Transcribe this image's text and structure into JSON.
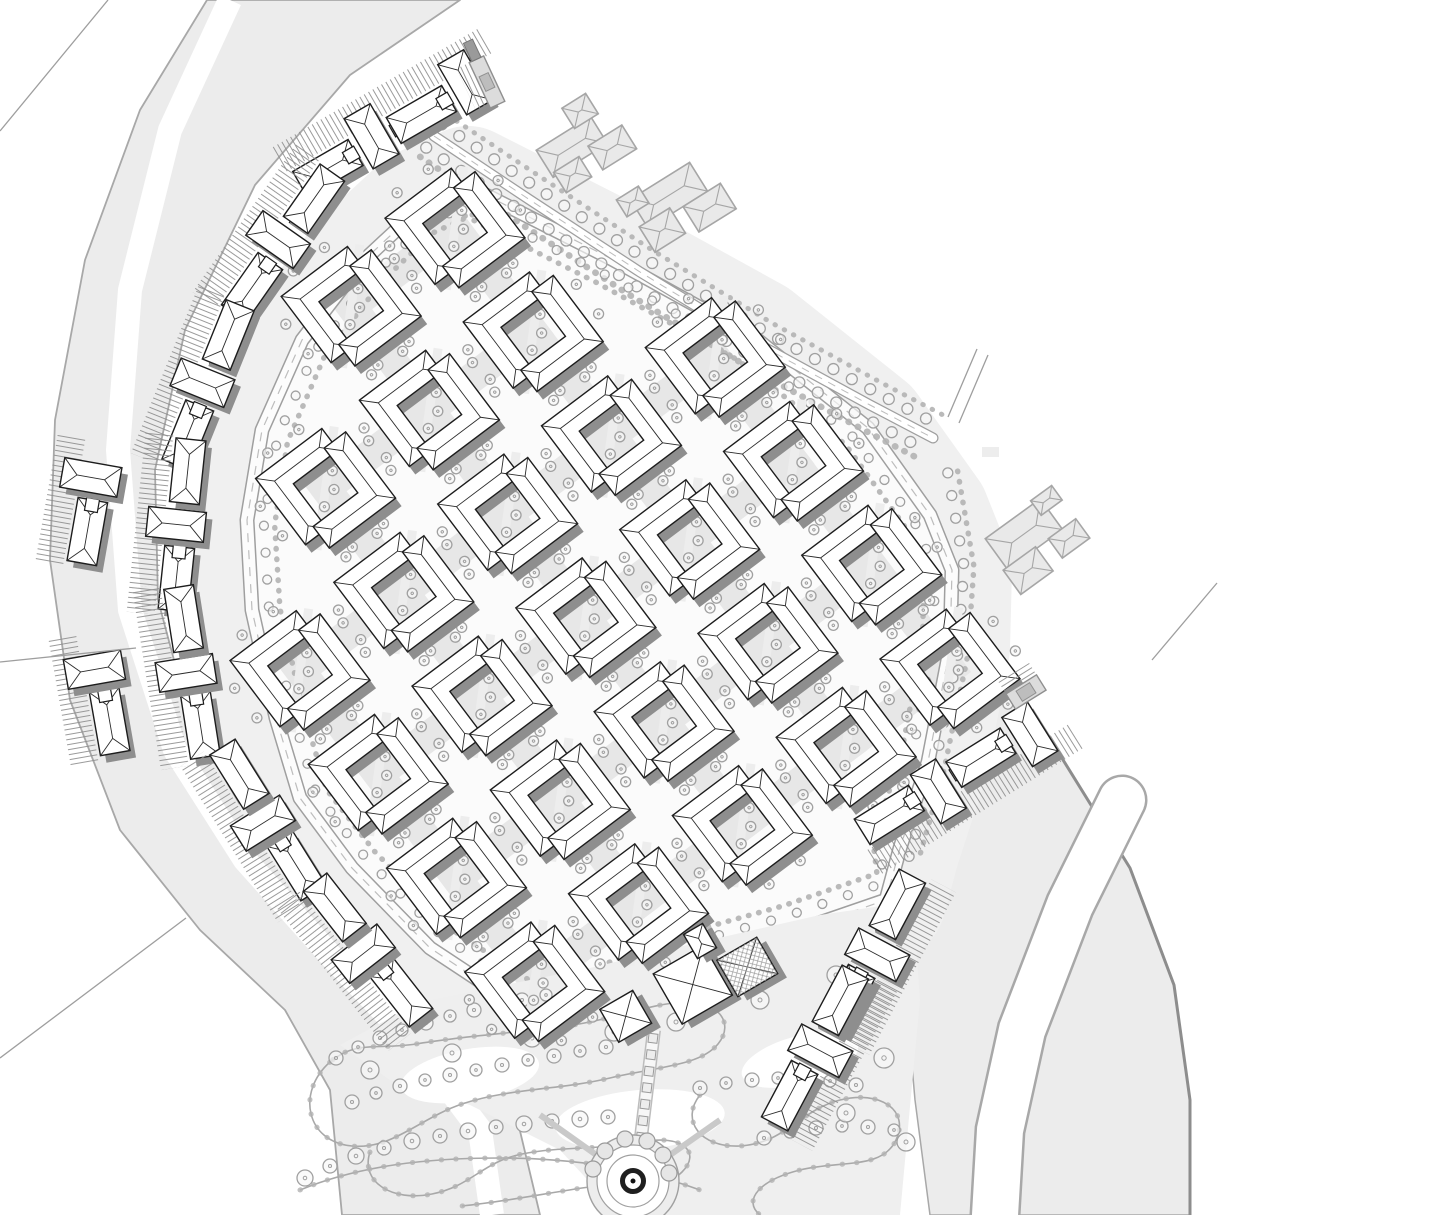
{
  "meta": {
    "drawing_type": "residential-master-site-plan",
    "canvas": {
      "w": 1448,
      "h": 1215
    }
  },
  "palette": {
    "bg": "#ffffff",
    "band_fill": "#ececec",
    "band_stroke": "#a8a8a8",
    "band_dark_edge": "#8d8d8d",
    "platform": "#f0f0f0",
    "site_fill": "#fbfbfb",
    "street": "#e7e7e7",
    "road_edge": "#9f9f9f",
    "road_fill": "#fcfcfc",
    "road_dash": "#bdbdbd",
    "tree_stroke": "#a0a0a0",
    "tree_fill": "#f7f7f7",
    "shrub": "#b2b2b2",
    "building_stroke": "#1c1c1c",
    "roof_line": "#2a2a2a",
    "shadow": "#8e8e8e",
    "hatch_line": "#8f8f8f",
    "context_fill": "#e9e9e9",
    "context_stroke": "#a6a6a6",
    "park_fill": "#efefef",
    "park_path": "#a8a8a8",
    "fountain_dark": "#1f1f1f"
  },
  "bands": {
    "west_poly": [
      207,
      0,
      140,
      110,
      85,
      260,
      55,
      420,
      50,
      560,
      70,
      700,
      120,
      830,
      200,
      930,
      285,
      1010,
      330,
      1090,
      342,
      1215,
      540,
      1215,
      515,
      1110,
      445,
      1020,
      350,
      925,
      255,
      830,
      190,
      720,
      158,
      600,
      155,
      470,
      185,
      330,
      255,
      185,
      350,
      75,
      460,
      0
    ],
    "west_white_stroke": [
      230,
      0,
      170,
      130,
      130,
      290,
      118,
      450,
      130,
      610,
      175,
      750,
      245,
      860,
      330,
      955,
      420,
      1050,
      480,
      1130,
      492,
      1215
    ],
    "west_white_width": 24,
    "southeast_poly": [
      985,
      660,
      1060,
      755,
      1130,
      868,
      1174,
      985,
      1190,
      1100,
      1190,
      1215,
      930,
      1215,
      915,
      1100,
      905,
      985,
      920,
      875,
      950,
      770,
      970,
      700
    ],
    "southeast_dark_edge": [
      985,
      660,
      1060,
      755,
      1130,
      868,
      1174,
      985,
      1190,
      1100,
      1190,
      1215
    ],
    "canal_path": [
      1122,
      800,
      1070,
      905,
      1022,
      1030,
      1000,
      1130,
      995,
      1215
    ],
    "canal_width": 46,
    "hairlines": [
      [
        948,
        417,
        977,
        349
      ],
      [
        959,
        423,
        988,
        355
      ],
      [
        1152,
        660,
        1217,
        583
      ],
      [
        0,
        131,
        108,
        0
      ],
      [
        0,
        1058,
        186,
        918
      ],
      [
        0,
        662,
        136,
        648
      ]
    ],
    "small_pad": {
      "x": 982,
      "y": 447,
      "w": 17,
      "h": 10
    }
  },
  "site": {
    "boundary": [
      468,
      186,
      610,
      258,
      755,
      338,
      868,
      428,
      930,
      515,
      952,
      570,
      950,
      648,
      928,
      762,
      900,
      848,
      886,
      900,
      790,
      933,
      700,
      958,
      620,
      988,
      548,
      1026,
      430,
      948,
      352,
      868,
      300,
      798,
      276,
      718,
      252,
      610,
      247,
      520,
      262,
      430,
      302,
      340,
      362,
      262,
      420,
      208
    ],
    "loop_road_width": 15,
    "platform_width": 120
  },
  "grid": {
    "origin": [
      455,
      228
    ],
    "angle_deg": -37,
    "pitch": 130,
    "block_size": 100,
    "cells": [
      [
        0,
        0
      ],
      [
        0,
        -1
      ],
      [
        1,
        0
      ],
      [
        1,
        -1
      ],
      [
        1,
        -2
      ],
      [
        2,
        1
      ],
      [
        2,
        0
      ],
      [
        2,
        -1
      ],
      [
        2,
        -2
      ],
      [
        2,
        -3
      ],
      [
        3,
        1
      ],
      [
        3,
        0
      ],
      [
        3,
        -1
      ],
      [
        3,
        -2
      ],
      [
        3,
        -3
      ],
      [
        4,
        1
      ],
      [
        4,
        0
      ],
      [
        4,
        -1
      ],
      [
        4,
        -2
      ],
      [
        4,
        -3
      ],
      [
        5,
        1
      ],
      [
        5,
        0
      ],
      [
        5,
        -1
      ],
      [
        5,
        -2
      ],
      [
        5,
        -3
      ]
    ],
    "street_width": 30
  },
  "boulevard": {
    "path": [
      434,
      136,
      530,
      200,
      640,
      272,
      760,
      345,
      870,
      405,
      933,
      438
    ],
    "road_width": 11,
    "tree_offset": 14,
    "tree_spacing": 21,
    "tree_r": 5.5,
    "shrub_offset": 25
  },
  "east_row": {
    "path": [
      936,
      475,
      952,
      565,
      946,
      652,
      922,
      768,
      897,
      855
    ],
    "tree_offset": -12,
    "tree_spacing": 23,
    "tree_r": 5
  },
  "loop_planting": {
    "offset": 17,
    "spacing": 27,
    "tree_r": 4.5
  },
  "chains": [
    {
      "c": [
        398,
        128
      ],
      "rot": -30,
      "units": 4,
      "hatch": -1
    },
    {
      "c": [
        283,
        243
      ],
      "rot": -55,
      "units": 3,
      "hatch": -1
    },
    {
      "c": [
        208,
        385
      ],
      "rot": -68,
      "units": 3,
      "hatch": -1
    },
    {
      "c": [
        182,
        525
      ],
      "rot": -84,
      "units": 3,
      "hatch": -1
    },
    {
      "c": [
        192,
        672
      ],
      "rot": -99,
      "units": 3,
      "hatch": -1
    },
    {
      "c": [
        268,
        820
      ],
      "rot": -122,
      "units": 3,
      "hatch": -1
    },
    {
      "c": [
        368,
        950
      ],
      "rot": -128,
      "units": 3,
      "hatch": -1
    },
    {
      "c": [
        92,
        505
      ],
      "rot": -80,
      "units": 2,
      "hatch": -1
    },
    {
      "c": [
        105,
        695
      ],
      "rot": -100,
      "units": 2,
      "hatch": -1
    },
    {
      "c": [
        958,
        772
      ],
      "rot": -32,
      "units": 4,
      "hatch": 1
    },
    {
      "c": [
        872,
        952
      ],
      "rot": -62,
      "units": 3,
      "hatch": 1
    },
    {
      "c": [
        815,
        1048
      ],
      "rot": -62,
      "units": 3,
      "hatch": 1
    }
  ],
  "context_buildings": [
    {
      "c": [
        593,
        143
      ],
      "rot": -32,
      "parts": [
        [
          -20,
          -8,
          64,
          32
        ],
        [
          14,
          14,
          40,
          28
        ],
        [
          -34,
          16,
          30,
          24
        ],
        [
          6,
          -34,
          28,
          24
        ]
      ]
    },
    {
      "c": [
        688,
        207
      ],
      "rot": -32,
      "parts": [
        [
          -10,
          -20,
          70,
          34
        ],
        [
          -34,
          6,
          36,
          30
        ],
        [
          18,
          12,
          44,
          30
        ],
        [
          -44,
          -34,
          26,
          20
        ]
      ]
    },
    {
      "c": [
        1043,
        540
      ],
      "rot": -36,
      "parts": [
        [
          -12,
          -16,
          68,
          38
        ],
        [
          -30,
          16,
          40,
          30
        ],
        [
          22,
          14,
          34,
          24
        ],
        [
          26,
          -30,
          26,
          18
        ]
      ]
    }
  ],
  "gates": [
    {
      "c": [
        487,
        82
      ],
      "rot": -25,
      "w": 16,
      "h": 50,
      "tower": true
    },
    {
      "c": [
        1026,
        692
      ],
      "rot": 58,
      "w": 18,
      "h": 36,
      "tower": false
    }
  ],
  "clubhouse": {
    "c": [
      700,
      985
    ],
    "rot": -30,
    "parts": [
      {
        "d": [
          -80,
          -10,
          38,
          38
        ],
        "x_roof": true,
        "hatch": false
      },
      {
        "d": [
          -6,
          -4,
          58,
          58
        ],
        "x_roof": true,
        "hatch": false
      },
      {
        "d": [
          50,
          8,
          46,
          42
        ],
        "x_roof": true,
        "hatch": true
      },
      {
        "d": [
          22,
          -38,
          22,
          28
        ],
        "x_roof": false,
        "hatch": false
      }
    ]
  },
  "park": {
    "poly": [
      340,
      1045,
      420,
      1002,
      505,
      985,
      590,
      968,
      665,
      950,
      745,
      932,
      820,
      915,
      888,
      905,
      915,
      930,
      920,
      1000,
      912,
      1085,
      900,
      1215,
      620,
      1215,
      560,
      1150,
      470,
      1105,
      390,
      1080
    ],
    "white_blobs": [
      [
        470,
        1075,
        70,
        26,
        -10
      ],
      [
        640,
        1120,
        85,
        30,
        -5
      ],
      [
        800,
        1060,
        60,
        24,
        -15
      ]
    ],
    "paths": [
      "M 330,1062 C 296,1092 306,1142 352,1146 C 392,1150 420,1118 462,1104 C 510,1088 560,1090 610,1078 C 656,1067 700,1066 718,1044 C 736,1022 716,1000 684,1002 C 648,1004 612,1020 566,1026 C 516,1033 462,1036 416,1044 C 376,1050 356,1040 330,1062 Z",
      "M 370,1152 C 360,1182 392,1202 432,1194 C 472,1186 482,1162 522,1154 C 562,1146 602,1150 642,1142 C 682,1134 702,1152 682,1172 C 662,1192 622,1182 582,1188 C 542,1194 502,1202 462,1206",
      "M 700,1095 C 680,1120 700,1148 740,1146 C 786,1143 800,1110 840,1100 C 880,1090 910,1110 896,1140 C 882,1170 840,1160 800,1170 C 760,1180 742,1200 760,1215",
      "M 300,1190 C 360,1165 430,1158 500,1158 C 570,1158 640,1168 700,1190"
    ],
    "trees": [
      [
        336,
        1058,
        7
      ],
      [
        358,
        1047,
        6
      ],
      [
        380,
        1038,
        7
      ],
      [
        402,
        1030,
        6
      ],
      [
        426,
        1023,
        7
      ],
      [
        450,
        1016,
        6
      ],
      [
        474,
        1010,
        7
      ],
      [
        498,
        1005,
        6
      ],
      [
        522,
        1000,
        7
      ],
      [
        546,
        995,
        6
      ],
      [
        352,
        1102,
        7
      ],
      [
        376,
        1093,
        6
      ],
      [
        400,
        1086,
        7
      ],
      [
        425,
        1080,
        6
      ],
      [
        450,
        1075,
        7
      ],
      [
        476,
        1070,
        6
      ],
      [
        502,
        1065,
        7
      ],
      [
        528,
        1060,
        6
      ],
      [
        554,
        1056,
        7
      ],
      [
        580,
        1051,
        6
      ],
      [
        606,
        1047,
        7
      ],
      [
        305,
        1178,
        8
      ],
      [
        330,
        1166,
        7
      ],
      [
        356,
        1156,
        8
      ],
      [
        384,
        1148,
        7
      ],
      [
        412,
        1141,
        8
      ],
      [
        440,
        1136,
        7
      ],
      [
        468,
        1131,
        8
      ],
      [
        496,
        1127,
        7
      ],
      [
        524,
        1124,
        8
      ],
      [
        552,
        1121,
        7
      ],
      [
        580,
        1119,
        8
      ],
      [
        608,
        1117,
        7
      ],
      [
        700,
        1088,
        7
      ],
      [
        726,
        1083,
        6
      ],
      [
        752,
        1080,
        7
      ],
      [
        778,
        1078,
        6
      ],
      [
        804,
        1078,
        7
      ],
      [
        830,
        1081,
        6
      ],
      [
        856,
        1085,
        7
      ],
      [
        764,
        1138,
        7
      ],
      [
        790,
        1132,
        6
      ],
      [
        816,
        1128,
        7
      ],
      [
        842,
        1126,
        6
      ],
      [
        868,
        1127,
        7
      ],
      [
        894,
        1130,
        6
      ],
      [
        676,
        1022,
        9
      ],
      [
        760,
        1000,
        9
      ],
      [
        836,
        975,
        9
      ],
      [
        884,
        1058,
        10
      ],
      [
        846,
        1113,
        9
      ],
      [
        906,
        1142,
        9
      ],
      [
        370,
        1070,
        9
      ],
      [
        452,
        1053,
        9
      ],
      [
        532,
        1038,
        9
      ],
      [
        614,
        1032,
        9
      ]
    ],
    "axis": {
      "from": [
        654,
        1030
      ],
      "to": [
        638,
        1162
      ],
      "pavers": 8,
      "paver_size": 9
    },
    "fountain": {
      "c": [
        633,
        1181
      ],
      "plaza_radii": [
        46,
        36,
        26
      ],
      "ring_r": 10.5,
      "ring_w": 5,
      "dot_r": 2.5,
      "petals": [
        [
          -28,
          -30
        ],
        [
          -8,
          -42
        ],
        [
          14,
          -40
        ],
        [
          30,
          -26
        ],
        [
          -40,
          -12
        ],
        [
          36,
          -8
        ]
      ],
      "petal_r": 8,
      "spokes": [
        [
          540,
          1115
        ],
        [
          720,
          1120
        ],
        [
          633,
          1215
        ]
      ]
    }
  },
  "block_geom": {
    "half": 50,
    "bar": 27,
    "L1": [
      -50,
      -50,
      33,
      -50,
      33,
      -23,
      -23,
      -23,
      -23,
      33,
      -50,
      33
    ],
    "L1_lines": [
      [
        -50,
        -50,
        -36.5,
        -36.5
      ],
      [
        -36.5,
        -36.5,
        19.5,
        -36.5
      ],
      [
        33,
        -50,
        19.5,
        -36.5
      ],
      [
        33,
        -23,
        19.5,
        -36.5
      ],
      [
        -36.5,
        -36.5,
        -36.5,
        19.5
      ],
      [
        -50,
        33,
        -36.5,
        19.5
      ],
      [
        -23,
        33,
        -36.5,
        19.5
      ]
    ],
    "street_trees": [
      [
        -63,
        -25
      ],
      [
        -63,
        12
      ],
      [
        -25,
        -63
      ],
      [
        14,
        -63
      ],
      [
        63,
        25
      ],
      [
        63,
        -12
      ],
      [
        25,
        63
      ],
      [
        -14,
        63
      ]
    ],
    "court_trees": [
      [
        6,
        6
      ],
      [
        -12,
        14
      ],
      [
        16,
        -10
      ]
    ],
    "tree_r": 5,
    "shadow_dx": 6,
    "shadow_dy": 8
  },
  "chain_geom": {
    "long_w": 64,
    "long_h": 30,
    "cross_w": 30,
    "cross_h": 58,
    "step": 54,
    "link": 13,
    "stagger": 6,
    "hatch_band": [
      18,
      46
    ]
  }
}
